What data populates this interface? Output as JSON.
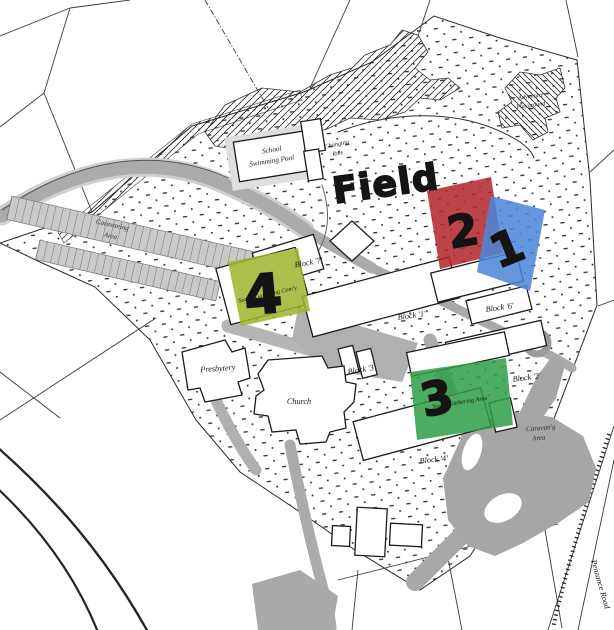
{
  "map": {
    "field_label": "Field",
    "highlights": [
      {
        "number": "1",
        "color": "#4c86d8"
      },
      {
        "number": "2",
        "color": "#b2272b"
      },
      {
        "number": "3",
        "color": "#2f9e47",
        "caption": "Social Gathering Area"
      },
      {
        "number": "4",
        "color": "#9eb42d",
        "caption": "Social Gathering Com'y"
      }
    ],
    "places": {
      "school_swimming_pool": {
        "line1": "School",
        "line2": "Swimming Pool"
      },
      "changing_rooms": {
        "line1": "Changing",
        "line2": "Rms"
      },
      "adventure_playground": {
        "line1": "Adventure",
        "line2": "Playground"
      },
      "caravaning_area_west": {
        "line1": "Caravaning",
        "line2": "Area"
      },
      "caravan_area_southeast": {
        "line1": "Caravan'g",
        "line2": "Area"
      },
      "presbytery": "Presbytery",
      "church": "Church",
      "penzance_road": "Penzance Road"
    },
    "blocks": [
      {
        "label": "Block '7'"
      },
      {
        "label": "Block '1'"
      },
      {
        "label": "Block '6'"
      },
      {
        "label": "Block '3'"
      },
      {
        "label": "Block '2'"
      },
      {
        "label": "Block '4'"
      }
    ],
    "colors": {
      "highlight_red": "#b2272b",
      "highlight_blue": "#4c86d8",
      "highlight_green": "#2f9e47",
      "highlight_olive": "#9eb42d",
      "road_gray": "#ababab",
      "ink": "#1c1c1c"
    }
  }
}
